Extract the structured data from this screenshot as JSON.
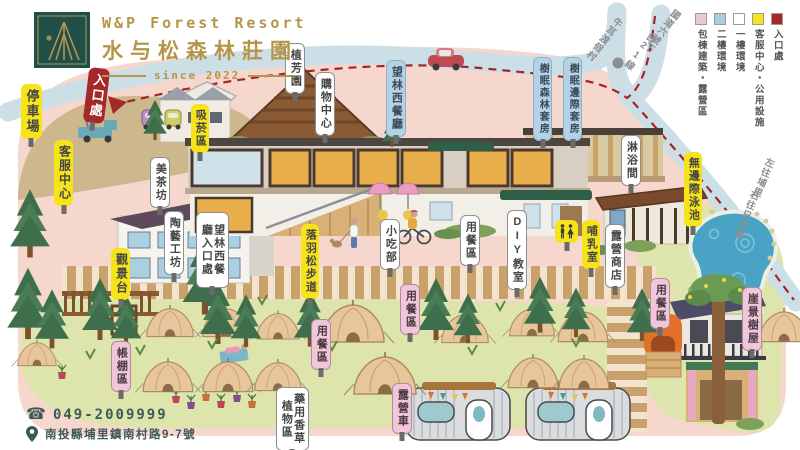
{
  "brand": {
    "logo_en": "W&P Forest Resort",
    "logo_zh": "水与松森林莊園",
    "since": "since 2022"
  },
  "legend": [
    {
      "label": "包棟建築・露營區",
      "color": "#ecc8d2"
    },
    {
      "label": "二樓環境",
      "color": "#a8cde2"
    },
    {
      "label": "一樓環境",
      "color": "#ffffff"
    },
    {
      "label": "客服中心・公用設施",
      "color": "#f6e319"
    },
    {
      "label": "入口處",
      "color": "#a5292a"
    }
  ],
  "contact": {
    "phone_icon": "☎",
    "phone": "049-2009999",
    "address": "南投縣埔里鎮南村路9-7號"
  },
  "road_texts": [
    {
      "id": "niuer-resort",
      "text": "牛耳渡假村",
      "x": 598,
      "y": 12,
      "rot": 38
    },
    {
      "id": "freeway-exit",
      "text": "國道六號下",
      "x": 656,
      "y": 4,
      "rot": 38
    },
    {
      "id": "route-21",
      "text": "台21線",
      "x": 634,
      "y": 28,
      "rot": 38
    },
    {
      "id": "left-puli",
      "text": "左往埔里",
      "x": 757,
      "y": 156,
      "rot": 22
    },
    {
      "id": "right-sunmoonlake",
      "text": "右往日月潭",
      "x": 740,
      "y": 188,
      "rot": 22
    }
  ],
  "map_labels": [
    {
      "id": "parking",
      "text": "停車場",
      "type": "yellow",
      "x": 21,
      "y": 84,
      "fs": 13
    },
    {
      "id": "entrance",
      "text": "入口處",
      "type": "red",
      "x": 86,
      "y": 68,
      "fs": 13,
      "rot": 7
    },
    {
      "id": "service-center",
      "text": "客服中心",
      "type": "yellow",
      "x": 54,
      "y": 140,
      "fs": 12
    },
    {
      "id": "viewing-deck",
      "text": "觀景台",
      "type": "yellow",
      "x": 111,
      "y": 248,
      "fs": 12
    },
    {
      "id": "smoking-area",
      "text": "吸菸區",
      "type": "yellow",
      "x": 191,
      "y": 104
    },
    {
      "id": "tea-house",
      "text": "美茶坊",
      "type": "white",
      "x": 150,
      "y": 157
    },
    {
      "id": "pottery-studio",
      "text": "陶藝工坊",
      "type": "white",
      "x": 164,
      "y": 211
    },
    {
      "id": "botanic-garden",
      "text": "植芳園",
      "type": "white",
      "x": 285,
      "y": 43
    },
    {
      "id": "shopping-center",
      "text": "購物中心",
      "type": "white",
      "x": 315,
      "y": 72
    },
    {
      "id": "west-restaurant",
      "text": "望林西餐廳",
      "type": "blue",
      "x": 386,
      "y": 60
    },
    {
      "id": "west-restaurant-entrance",
      "text": "望林西餐廳入口處",
      "type": "white",
      "x": 196,
      "y": 212,
      "h": 64
    },
    {
      "id": "larch-trail",
      "text": "落羽松步道",
      "type": "yellow",
      "x": 301,
      "y": 224
    },
    {
      "id": "snack-bar",
      "text": "小吃部",
      "type": "white",
      "x": 380,
      "y": 219
    },
    {
      "id": "dining-a",
      "text": "用餐區",
      "type": "white",
      "x": 460,
      "y": 215
    },
    {
      "id": "diy-classroom",
      "text": "DIY教室",
      "type": "white",
      "x": 507,
      "y": 210
    },
    {
      "id": "forest-suite",
      "text": "樹眠森林套房",
      "type": "blue",
      "x": 533,
      "y": 57,
      "fs": 10
    },
    {
      "id": "edge-suite",
      "text": "樹眠邊際套房",
      "type": "blue",
      "x": 563,
      "y": 57,
      "fs": 10
    },
    {
      "id": "shower-room",
      "text": "淋浴間",
      "type": "white",
      "x": 621,
      "y": 135
    },
    {
      "id": "infinity-pool",
      "text": "無邊際泳池",
      "type": "yellow",
      "x": 684,
      "y": 152
    },
    {
      "id": "restroom",
      "text": "",
      "type": "restroom",
      "x": 555,
      "y": 220
    },
    {
      "id": "nursing-room",
      "text": "哺乳室",
      "type": "yellow",
      "x": 582,
      "y": 220
    },
    {
      "id": "camp-store",
      "text": "露營商店",
      "type": "white",
      "x": 605,
      "y": 224
    },
    {
      "id": "dining-b",
      "text": "用餐區",
      "type": "pink",
      "x": 400,
      "y": 284
    },
    {
      "id": "dining-c",
      "text": "用餐區",
      "type": "pink",
      "x": 311,
      "y": 319
    },
    {
      "id": "dining-d",
      "text": "用餐區",
      "type": "pink",
      "x": 650,
      "y": 278
    },
    {
      "id": "cliff-treehouse",
      "text": "崖景樹屋",
      "type": "pink",
      "x": 742,
      "y": 287
    },
    {
      "id": "tent-area",
      "text": "帳棚區",
      "type": "pink",
      "x": 111,
      "y": 341
    },
    {
      "id": "herb-garden",
      "text": "藥用香草植物區",
      "type": "white",
      "x": 276,
      "y": 387,
      "h": 52
    },
    {
      "id": "camper-van",
      "text": "露營車",
      "type": "pink",
      "x": 392,
      "y": 383
    }
  ]
}
